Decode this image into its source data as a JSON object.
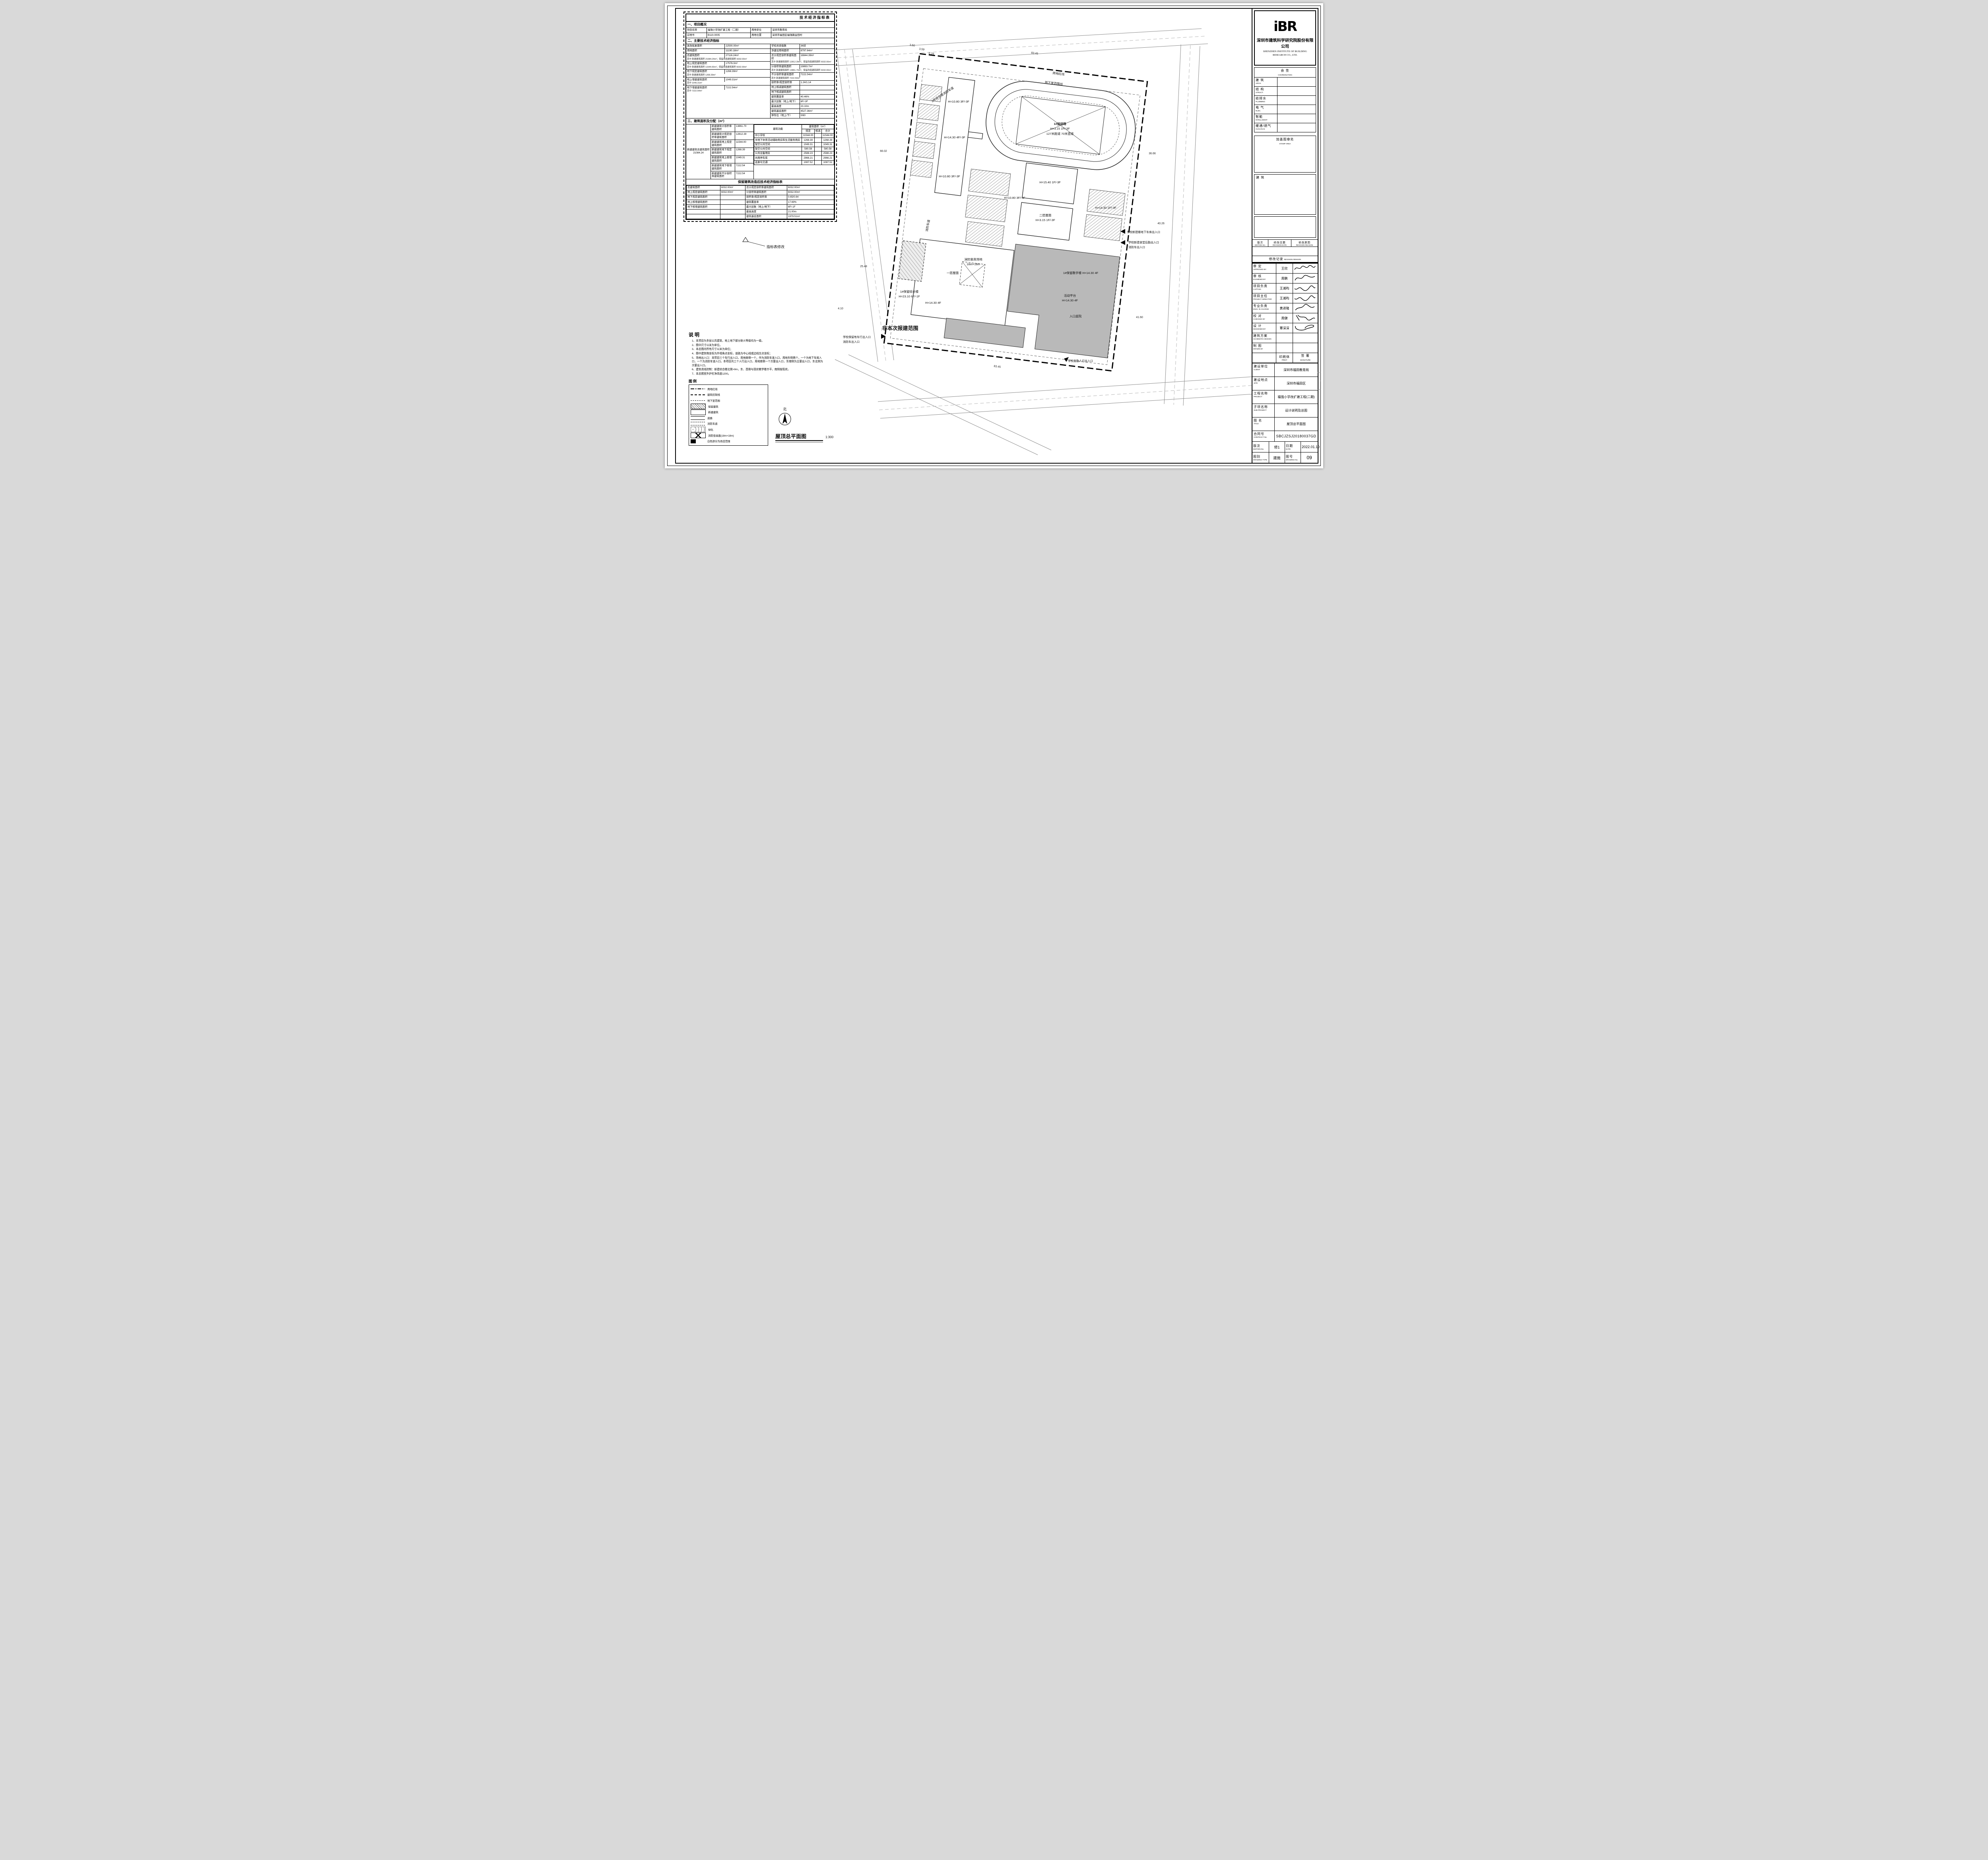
{
  "table1": {
    "title": "技术经济指标表",
    "s1_head": "一、项目概况",
    "s1": {
      "rows": [
        [
          "项目名称",
          "福强小学改扩建工程（二期）",
          "用地单位",
          "深圳市教育局"
        ],
        [
          "宗地号",
          "B110-0005",
          "用地位置",
          "深圳市福田区福强路益田村"
        ]
      ]
    },
    "s2_head": "二、主要技术经济指标",
    "s2": {
      "left": [
        {
          "l": "发改批复面积",
          "v": "22500.00m²",
          "sub": ""
        },
        {
          "l": "用地面积",
          "v": "11190.18m²",
          "sub": ""
        },
        {
          "l": "总建筑面积",
          "v": "27116.24m²",
          "sub": "其中 新建建筑面积 21084.24m²；保留改造建筑面积 6032.00m²"
        },
        {
          "l": "地上规定建筑面积",
          "v": "17576.0m²",
          "sub": "其中 新建建筑面积 11544.00m²；保留改造建筑面积 6032.00m²"
        },
        {
          "l": "地下规定建筑面积",
          "v": "1268.39m²",
          "sub": "其中 新建建筑面积 1268.39m²"
        },
        {
          "l": "地上增建建筑面积",
          "v": "1049.31m²",
          "sub": "其中 1049.31m²"
        },
        {
          "l": "地下增建建筑面积",
          "v": "7222.54m²",
          "sub": "其中 7222.54m²"
        }
      ],
      "right": [
        {
          "l": "学校总班级数",
          "v": "36班"
        },
        {
          "l": "净建设用地面积",
          "v": "8797.64m²"
        },
        {
          "l": "总计规定容积率建筑面积",
          "v": "18844.39m²"
        },
        {
          "l": "计容积率建筑面积",
          "v": "19893.7m²"
        },
        {
          "l": "不计容积率建筑面积",
          "v": "7222.54m²"
        },
        {
          "l": "容积率/规定容积率",
          "v": "1.24/1.14"
        },
        {
          "l": "地上核减建筑面积",
          "v": ""
        },
        {
          "l": "地下核减建筑面积",
          "v": ""
        },
        {
          "l": "建筑覆盖率",
          "v": "40.46%"
        },
        {
          "l": "最大层数（地上/地下）",
          "v": "6F/-3F"
        },
        {
          "l": "最高高度",
          "v": "23.10m"
        },
        {
          "l": "建筑基底面积",
          "v": "4527.36m²"
        },
        {
          "l": "停车位（地上/下）",
          "v": "0/60"
        }
      ],
      "sub_r3": "其中 新建建筑面积 12812.39m²；保留改造建筑面积 6032.00m²",
      "sub_r4": "其中 新建建筑面积 13861.70m²；保留改造建筑面积 6032.00m²",
      "sub_r5": "其中 新建建筑面积 7222.54m²"
    },
    "s3_head": "三、建筑面积及分配（m²）",
    "s3": {
      "total_label": "新建建筑总建筑面积",
      "total": "21084.24",
      "mid": [
        {
          "l": "新建建筑计容积率建筑面积",
          "v": "13861.70"
        },
        {
          "l": "新建建筑计规定容积率建筑面积",
          "v": "12812.39"
        },
        {
          "l": "新建建筑地上规定建筑面积",
          "v": "11544.00"
        },
        {
          "l": "新建建筑地下规定建筑面积",
          "v": "1268.39"
        },
        {
          "l": "新建建筑地上核增建筑面积",
          "v": "1049.31"
        },
        {
          "l": "新建建筑地下核增建筑面积",
          "v": "7222.54"
        },
        {
          "l": "新建建筑不计容积率建筑面积",
          "v": "7222.54"
        }
      ],
      "fh": [
        "建筑功能",
        "规定",
        "核减",
        "合计"
      ],
      "fh_top": "建筑面积（m²）",
      "rows": [
        [
          "中小学校",
          "11544.00",
          "",
          "11544.00"
        ],
        [
          "半地下体育活动辅助用房和生活服务用房",
          "1268.39",
          "",
          "1268.39"
        ],
        [
          "架空公共空间",
          "1049.31",
          "",
          "1049.31"
        ],
        [
          "架空公共空间",
          "580.58",
          "",
          "580.58"
        ],
        [
          "公共设备用房",
          "2588.23",
          "",
          "2588.23"
        ],
        [
          "共用停车库",
          "2966.21",
          "",
          "2966.21"
        ],
        [
          "走廊与交通",
          "1087.52",
          "",
          "1087.52"
        ]
      ]
    },
    "s4_head": "保留建筑改造后技术经济指标表",
    "s4": {
      "rows": [
        [
          "总建筑面积",
          "6032.00m²",
          "总计规定容积率建筑面积",
          "6032.00m²"
        ],
        [
          "地上规定建筑面积",
          "6032.00m²",
          "计容积率建筑面积",
          "6032.00m²"
        ],
        [
          "地下规定建筑面积",
          "",
          "容积率/规定容积率",
          "0.65/0.64"
        ],
        [
          "地上核增建筑面积",
          "",
          "建筑覆盖率",
          "17.69%"
        ],
        [
          "地下核增建筑面积",
          "",
          "最大层数（地上/地下）",
          "6F/-1F"
        ],
        [
          "",
          "",
          "最高高度",
          "21.00m"
        ],
        [
          "",
          "",
          "建筑基底面积",
          "1979.51m²"
        ]
      ]
    }
  },
  "notes": {
    "title": "说明",
    "items": [
      "1、本项目为多层公共建筑，地上地下部分耐火等级均为一级。",
      "2、图中尺寸以米为单位。",
      "3、本总图内所有尺寸以米为单位；",
      "4、图中建筑物坐标为外墙角点坐标，道路为中心线或边线交点坐标；",
      "5、场地出入口：本项目三个车行出入口，用地南侧一个，作为消防车道入口，用地东侧两个，一个为地下车库入口，一个为消防车道入口。本项目共三个人行出入口，用地南侧一个次要出入口，东南侧为主要出入口，东北侧为次要出入口。",
      "6、建筑退线控制：新建综合楼北侧>9m，东、西侧与现状教学楼齐平，南侧按现状。",
      "7、本总图室外护栏净高度1200。"
    ]
  },
  "legend": {
    "title": "图例",
    "items": [
      "用地红线",
      "建筑控制线",
      "地下室范围",
      "保留建筑",
      "新建建筑",
      "道路",
      "消防车道",
      "绿化",
      "消防登高面(18m×18m)",
      "白色部分为改造范围"
    ]
  },
  "plan": {
    "labels": [
      "1#运动场",
      "H=3.15 1F/-3F",
      "127米跑道 70米直道",
      "H=10.80 3F/-3F",
      "H=14.30 4F/-3F",
      "H=10.80 3F/-3F",
      "H=15.40 1F/-3F",
      "二层屋面",
      "H=3.15 1F/-3F",
      "H=10.80 3F/-3F",
      "H=14.30 1F/-3F",
      "1#保留教学楼 H=14.30 4F",
      "活动平台",
      "H=14.30 4F",
      "入口庭院",
      "一层屋面",
      "消防登高场地",
      "18m×18m",
      "H=14.30 4F",
      "1#保留综合楼",
      "H=23.10 6F/-1F",
      "消防车道",
      "3号综合楼消防车道",
      "非本次报建范围",
      "用地红线",
      "地下室范围线",
      "学校新建楼地下车库出入口",
      "学校新建食堂后勤出入口",
      "消防车出入口",
      "学校后勤人行出入口",
      "学校保留有车行出入口",
      "消防车出入口",
      "83.45",
      "83.45",
      "36.66",
      "40.26",
      "41.60",
      "66.02",
      "25.48",
      "4.10",
      "3.50",
      "3.59",
      "0.29",
      "指标表修改",
      "北",
      "屋顶总平面图",
      "1:300"
    ]
  },
  "tb": {
    "logo": "iBR",
    "company_cn": "深圳市建筑科学研究院股份有限公司",
    "company_en": "SHENZHEN INSTITUTE OF BUILDING RESEARCH CO., LTD.",
    "coord_cn": "会 签",
    "coord_en": "COORDINATION",
    "coord_rows": [
      [
        "建 筑",
        "ARCH."
      ],
      [
        "结 构",
        "STRUCT."
      ],
      [
        "给排水",
        "PLUMBING"
      ],
      [
        "电 气",
        "ELEC."
      ],
      [
        "智能",
        "INTELLIGENT"
      ],
      [
        "暖通/燃气",
        "HVAC/GAS"
      ]
    ],
    "stamp_cn": "加盖图章处",
    "stamp_en": "STAMP AREA",
    "discipline": "建 筑",
    "rev_cols": [
      [
        "版次",
        "EDITION No."
      ],
      [
        "修改日期",
        "REVISION DATE"
      ],
      [
        "修改原因",
        "REVISION REASON"
      ]
    ],
    "rev_record_cn": "修改记录",
    "rev_record_en": "REVISION REMARK",
    "sign_rows": [
      [
        "审 定",
        "APPROVED BY",
        "王欣"
      ],
      [
        "审 核",
        "EXAMINED BY",
        "周鹏"
      ],
      [
        "项目负责",
        "CAPTAIN",
        "王湘昀"
      ],
      [
        "项目主任",
        "PROJECT DIRECTOR",
        "王湘昀"
      ],
      [
        "专业负责",
        "ENGI. IN CHARGE",
        "黄进隆"
      ],
      [
        "校 对",
        "CHECKED BY",
        "周健"
      ],
      [
        "设 计",
        "DESIGNED BY",
        "覃深深"
      ],
      [
        "建筑方案",
        "SCHEMATIC DESIGN",
        ""
      ],
      [
        "制 图",
        "DRAWN BY",
        ""
      ]
    ],
    "print_cn": "印刷体",
    "print_en": "PRINT",
    "sig_cn": "签 署",
    "sig_en": "SIGNATURE",
    "info_rows": [
      [
        "建设单位",
        "CLIENT",
        "深圳市福田教育局"
      ],
      [
        "建设地点",
        "SITE",
        "深圳市福田区"
      ],
      [
        "工程名称",
        "PROJECT",
        "福强小学改扩建工程(二期)"
      ],
      [
        "子项名称",
        "SUB-PROJECT",
        "设计说明及总图"
      ],
      [
        "图 名",
        "TITLE",
        "屋顶总平面图"
      ]
    ],
    "contract_cn": "合同号",
    "contract_en": "CONTRACT No.",
    "contract": "SBCJZSJ20180037GD",
    "edition_cn": "版次",
    "edition_en": "EDITION No.",
    "edition": "修1",
    "date_cn": "日期",
    "date_en": "DATE",
    "date": "2022.01.10",
    "dtype_cn": "图别",
    "dtype_en": "DRAWING TYPE",
    "dtype": "建施",
    "dno_cn": "图号",
    "dno_en": "DRAWING No.",
    "dno": "09"
  }
}
